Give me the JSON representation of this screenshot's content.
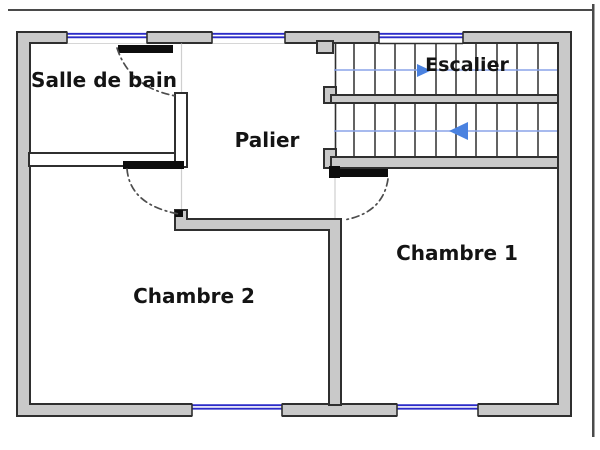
{
  "title": "Plan d'étage",
  "colors": {
    "background": "#ffffff",
    "wall-fill": "#c9c9c9",
    "wall-line": "#2f2f2f",
    "window-blue": "#2b2bc8",
    "stair-blue": "#8aa4e8",
    "arrow-blue": "#4a82e0",
    "door-black": "#0d0d0d",
    "arc-gray": "#4d4d4d",
    "faint-line": "#cfcfcf",
    "frame-gray": "#4a4a4a",
    "text-color": "#141414"
  },
  "rooms": {
    "salle_de_bain": "Salle de bain",
    "palier": "Palier",
    "escalier": "Escalier",
    "chambre1": "Chambre 1",
    "chambre2": "Chambre 2"
  }
}
